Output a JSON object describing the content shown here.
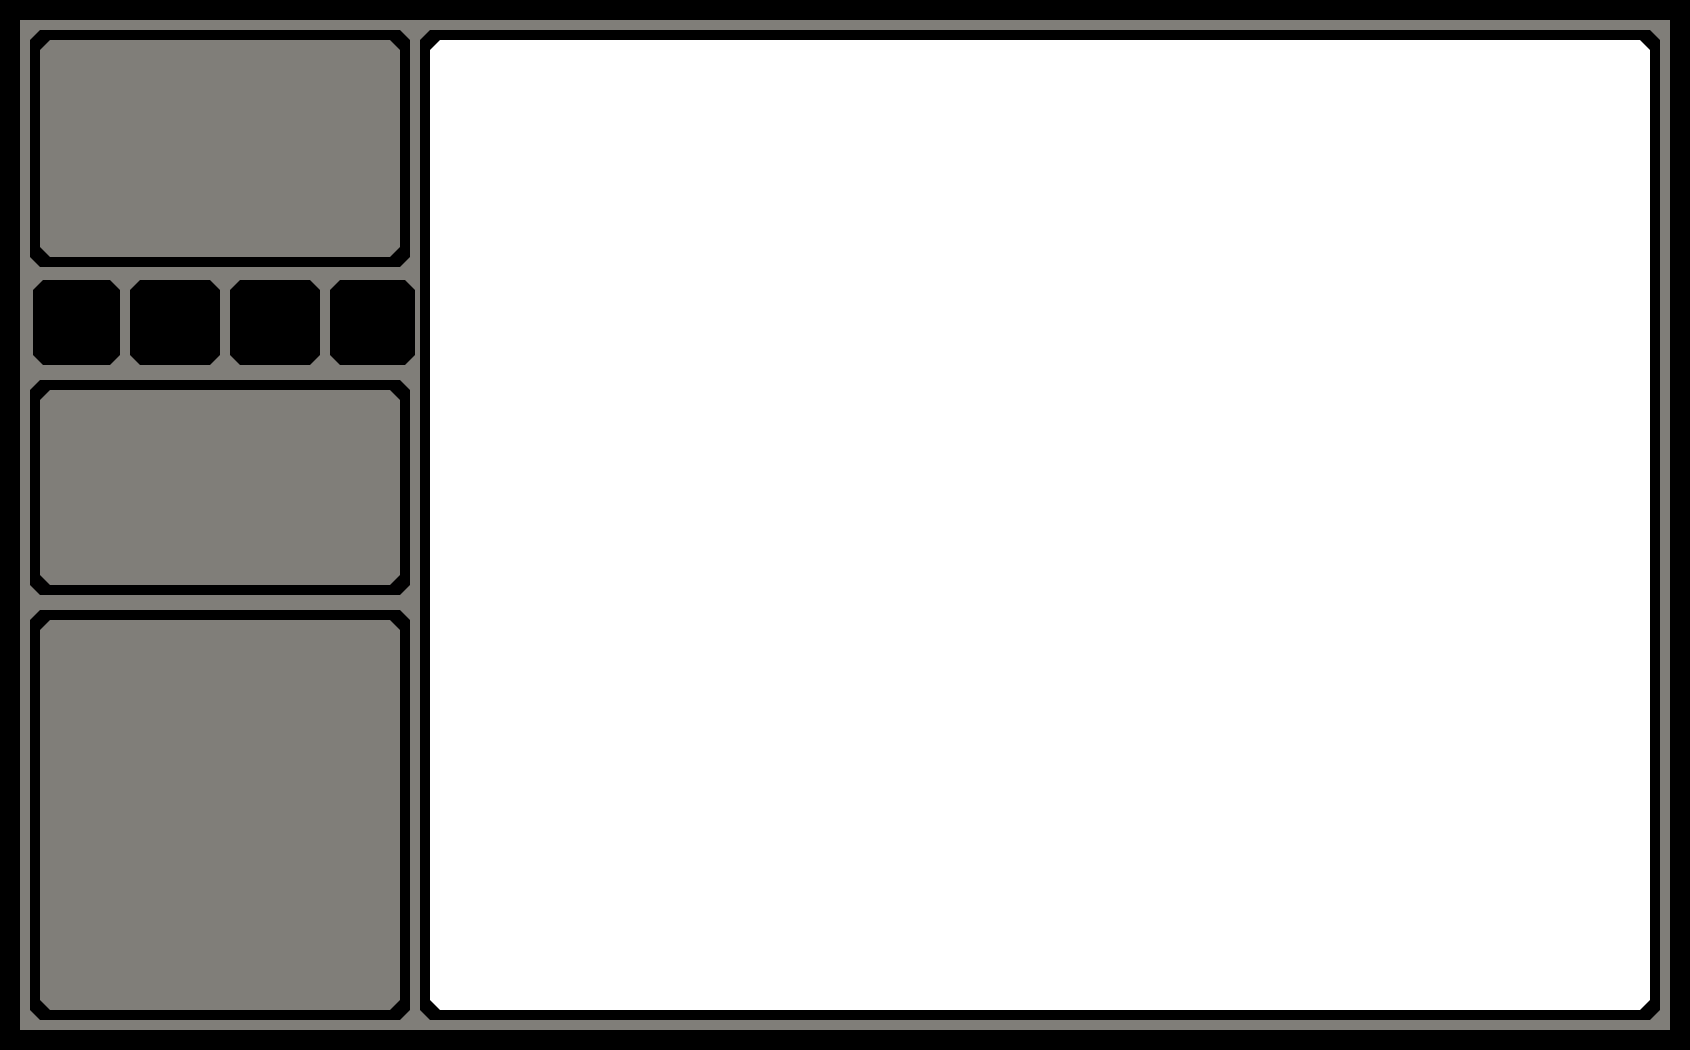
{
  "window": {
    "description": "abstract pixel-style application window wireframe, no visible text"
  },
  "colors": {
    "background": "#000000",
    "frame_gray": "#807E79",
    "panel_border": "#000000",
    "content_white": "#FFFFFF"
  },
  "sidebar": {
    "panels": [
      {
        "id": "top",
        "label": ""
      },
      {
        "id": "middle",
        "label": ""
      },
      {
        "id": "bottom",
        "label": ""
      }
    ],
    "buttons": [
      {
        "id": "button-1",
        "label": ""
      },
      {
        "id": "button-2",
        "label": ""
      },
      {
        "id": "button-3",
        "label": ""
      },
      {
        "id": "button-4",
        "label": ""
      }
    ]
  },
  "main": {
    "content": ""
  }
}
